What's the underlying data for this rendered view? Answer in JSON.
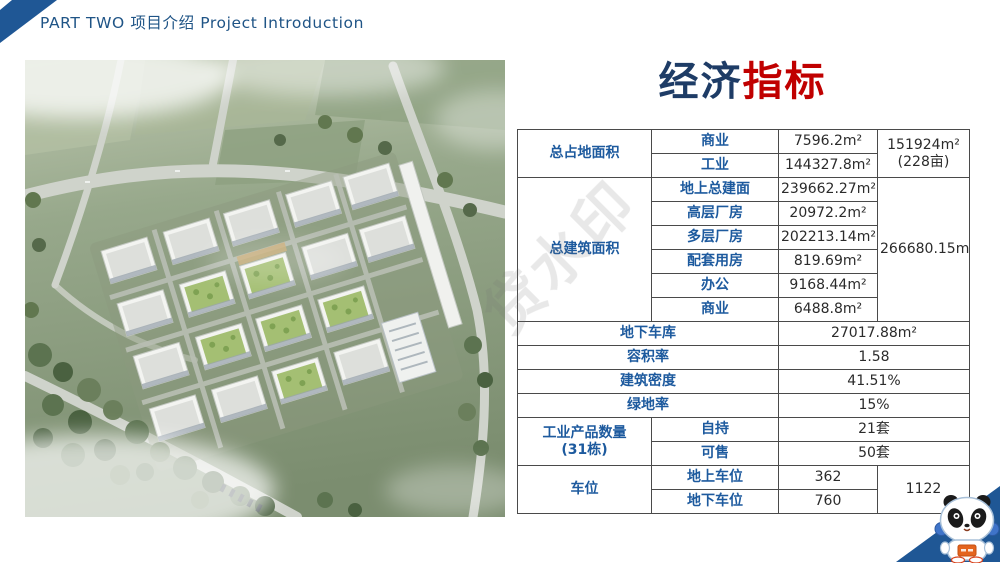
{
  "header": {
    "label": "PART TWO 项目介绍  Project Introduction"
  },
  "title": {
    "blue": "经济",
    "red": "指标"
  },
  "watermark": {
    "text": "贷水印"
  },
  "colors": {
    "accent_blue": "#1f5795",
    "title_blue": "#1e3c66",
    "title_red": "#c00000",
    "table_label_blue": "#1d5a9e"
  },
  "icons": {
    "mascot": "panda-astronaut-mascot",
    "corner": "corner-accent-ribbon"
  },
  "table": {
    "land": {
      "label": "总占地面积",
      "items": [
        {
          "name": "商业",
          "value": "7596.2m²"
        },
        {
          "name": "工业",
          "value": "144327.8m²"
        }
      ],
      "total": "151924m²\n(228亩)"
    },
    "building": {
      "label": "总建筑面积",
      "items": [
        {
          "name": "地上总建面",
          "value": "239662.27m²"
        },
        {
          "name": "高层厂房",
          "value": "20972.2m²"
        },
        {
          "name": "多层厂房",
          "value": "202213.14m²"
        },
        {
          "name": "配套用房",
          "value": "819.69m²"
        },
        {
          "name": "办公",
          "value": "9168.44m²"
        },
        {
          "name": "商业",
          "value": "6488.8m²"
        }
      ],
      "total": "266680.15m²"
    },
    "simple": [
      {
        "label": "地下车库",
        "value": "27017.88m²"
      },
      {
        "label": "容积率",
        "value": "1.58"
      },
      {
        "label": "建筑密度",
        "value": "41.51%"
      },
      {
        "label": "绿地率",
        "value": "15%"
      }
    ],
    "products": {
      "label": "工业产品数量\n(31栋)",
      "items": [
        {
          "name": "自持",
          "value": "21套"
        },
        {
          "name": "可售",
          "value": "50套"
        }
      ]
    },
    "parking": {
      "label": "车位",
      "items": [
        {
          "name": "地上车位",
          "value": "362"
        },
        {
          "name": "地下车位",
          "value": "760"
        }
      ],
      "total": "1122"
    }
  }
}
